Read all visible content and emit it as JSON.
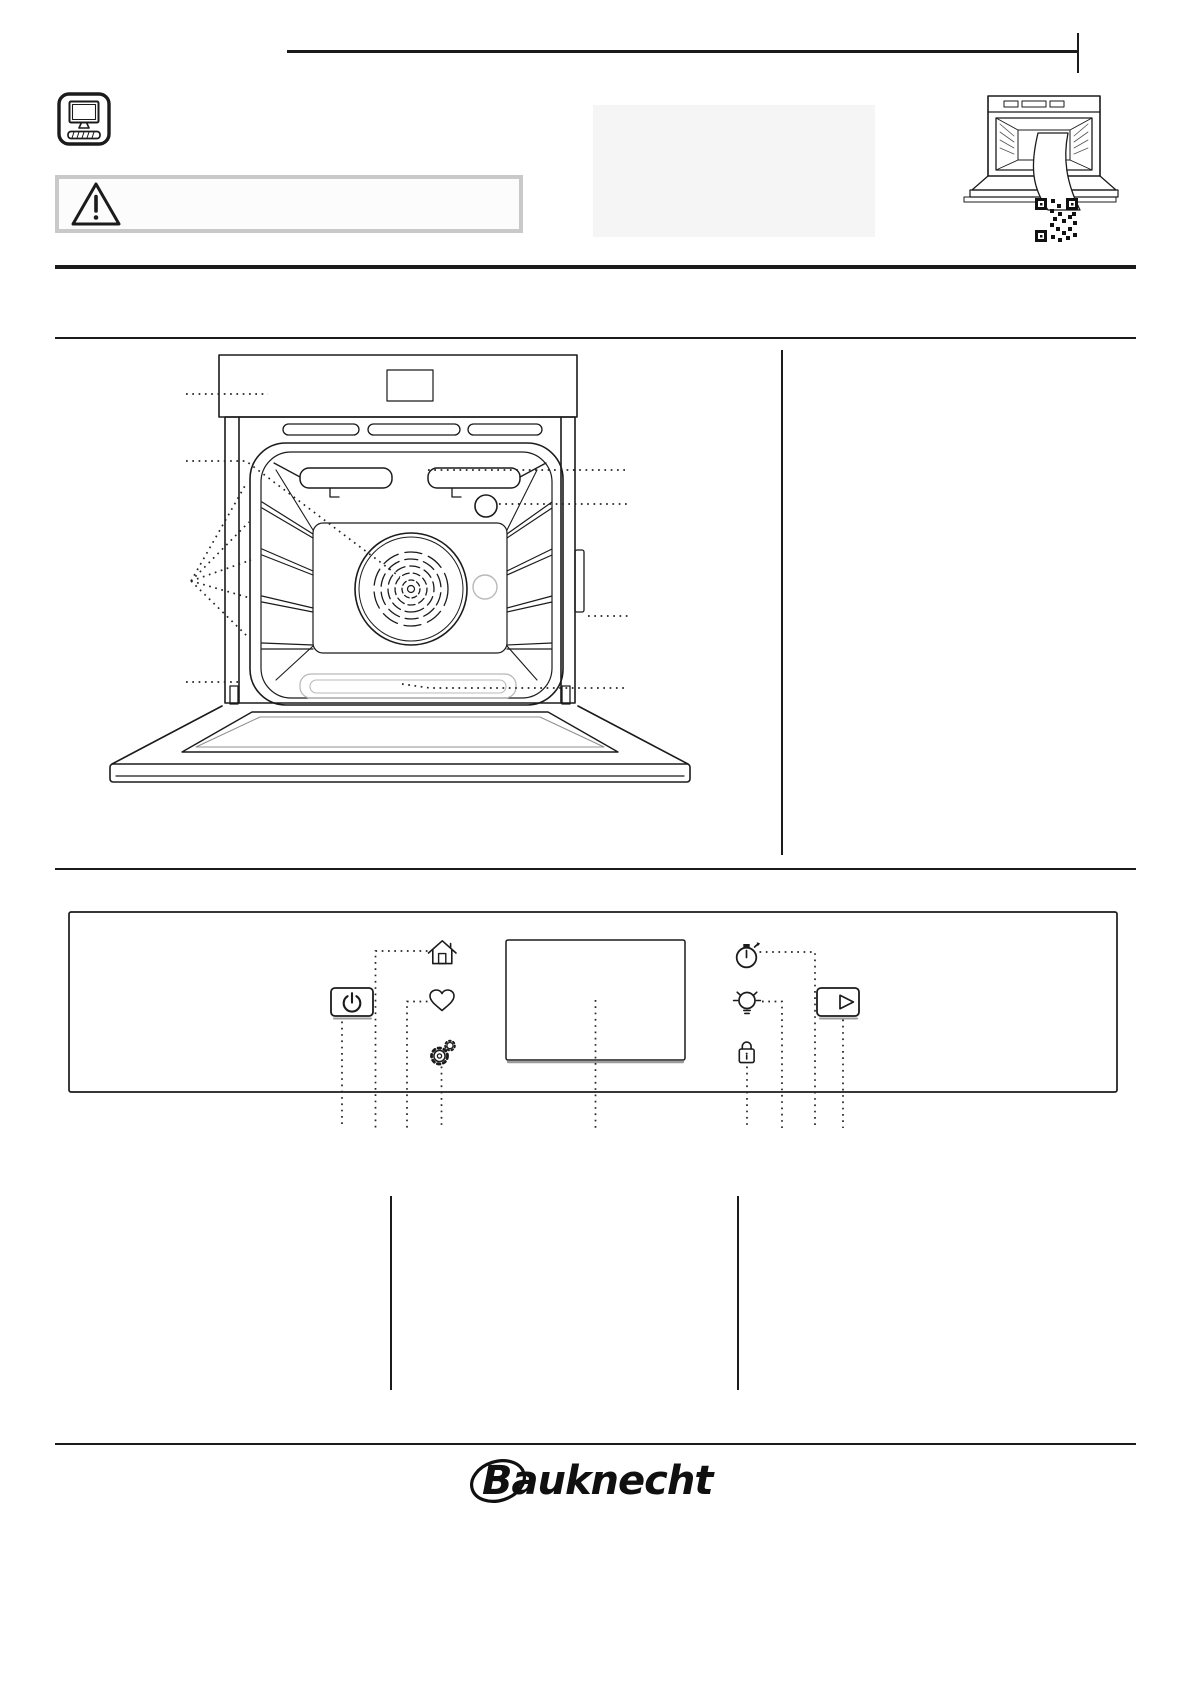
{
  "page": {
    "width": 1191,
    "height": 1684,
    "background": "#ffffff",
    "ink": "#1b1b1b"
  },
  "header": {
    "manual_icon": "computer-manual-icon",
    "warning_icon": "warning-triangle-icon",
    "thumbnail_icon": "oven-with-qr-code",
    "warning_border_color": "#c9c9c9",
    "panel_color": "#f6f5f6"
  },
  "oven_diagram": {
    "name": "oven-front-view",
    "callouts": [
      "control-panel",
      "grill-heating-element",
      "oven-lamp",
      "shelf-runner-levels",
      "fan",
      "identification-plate",
      "bottom-heating-element",
      "oven-door"
    ]
  },
  "control_panel": {
    "left_button": {
      "name": "power-button",
      "icon": "power-icon"
    },
    "right_button": {
      "name": "start-button",
      "icon": "play-icon"
    },
    "touch_symbols": [
      {
        "name": "home",
        "icon": "home-icon"
      },
      {
        "name": "favorites",
        "icon": "heart-icon"
      },
      {
        "name": "settings",
        "icon": "gear-icon"
      },
      {
        "name": "timer",
        "icon": "stopwatch-icon"
      },
      {
        "name": "lamp",
        "icon": "bulb-icon"
      },
      {
        "name": "key-lock",
        "icon": "padlock-icon"
      }
    ],
    "display": {
      "name": "display-screen"
    }
  },
  "footer": {
    "brand": "Bauknecht"
  }
}
